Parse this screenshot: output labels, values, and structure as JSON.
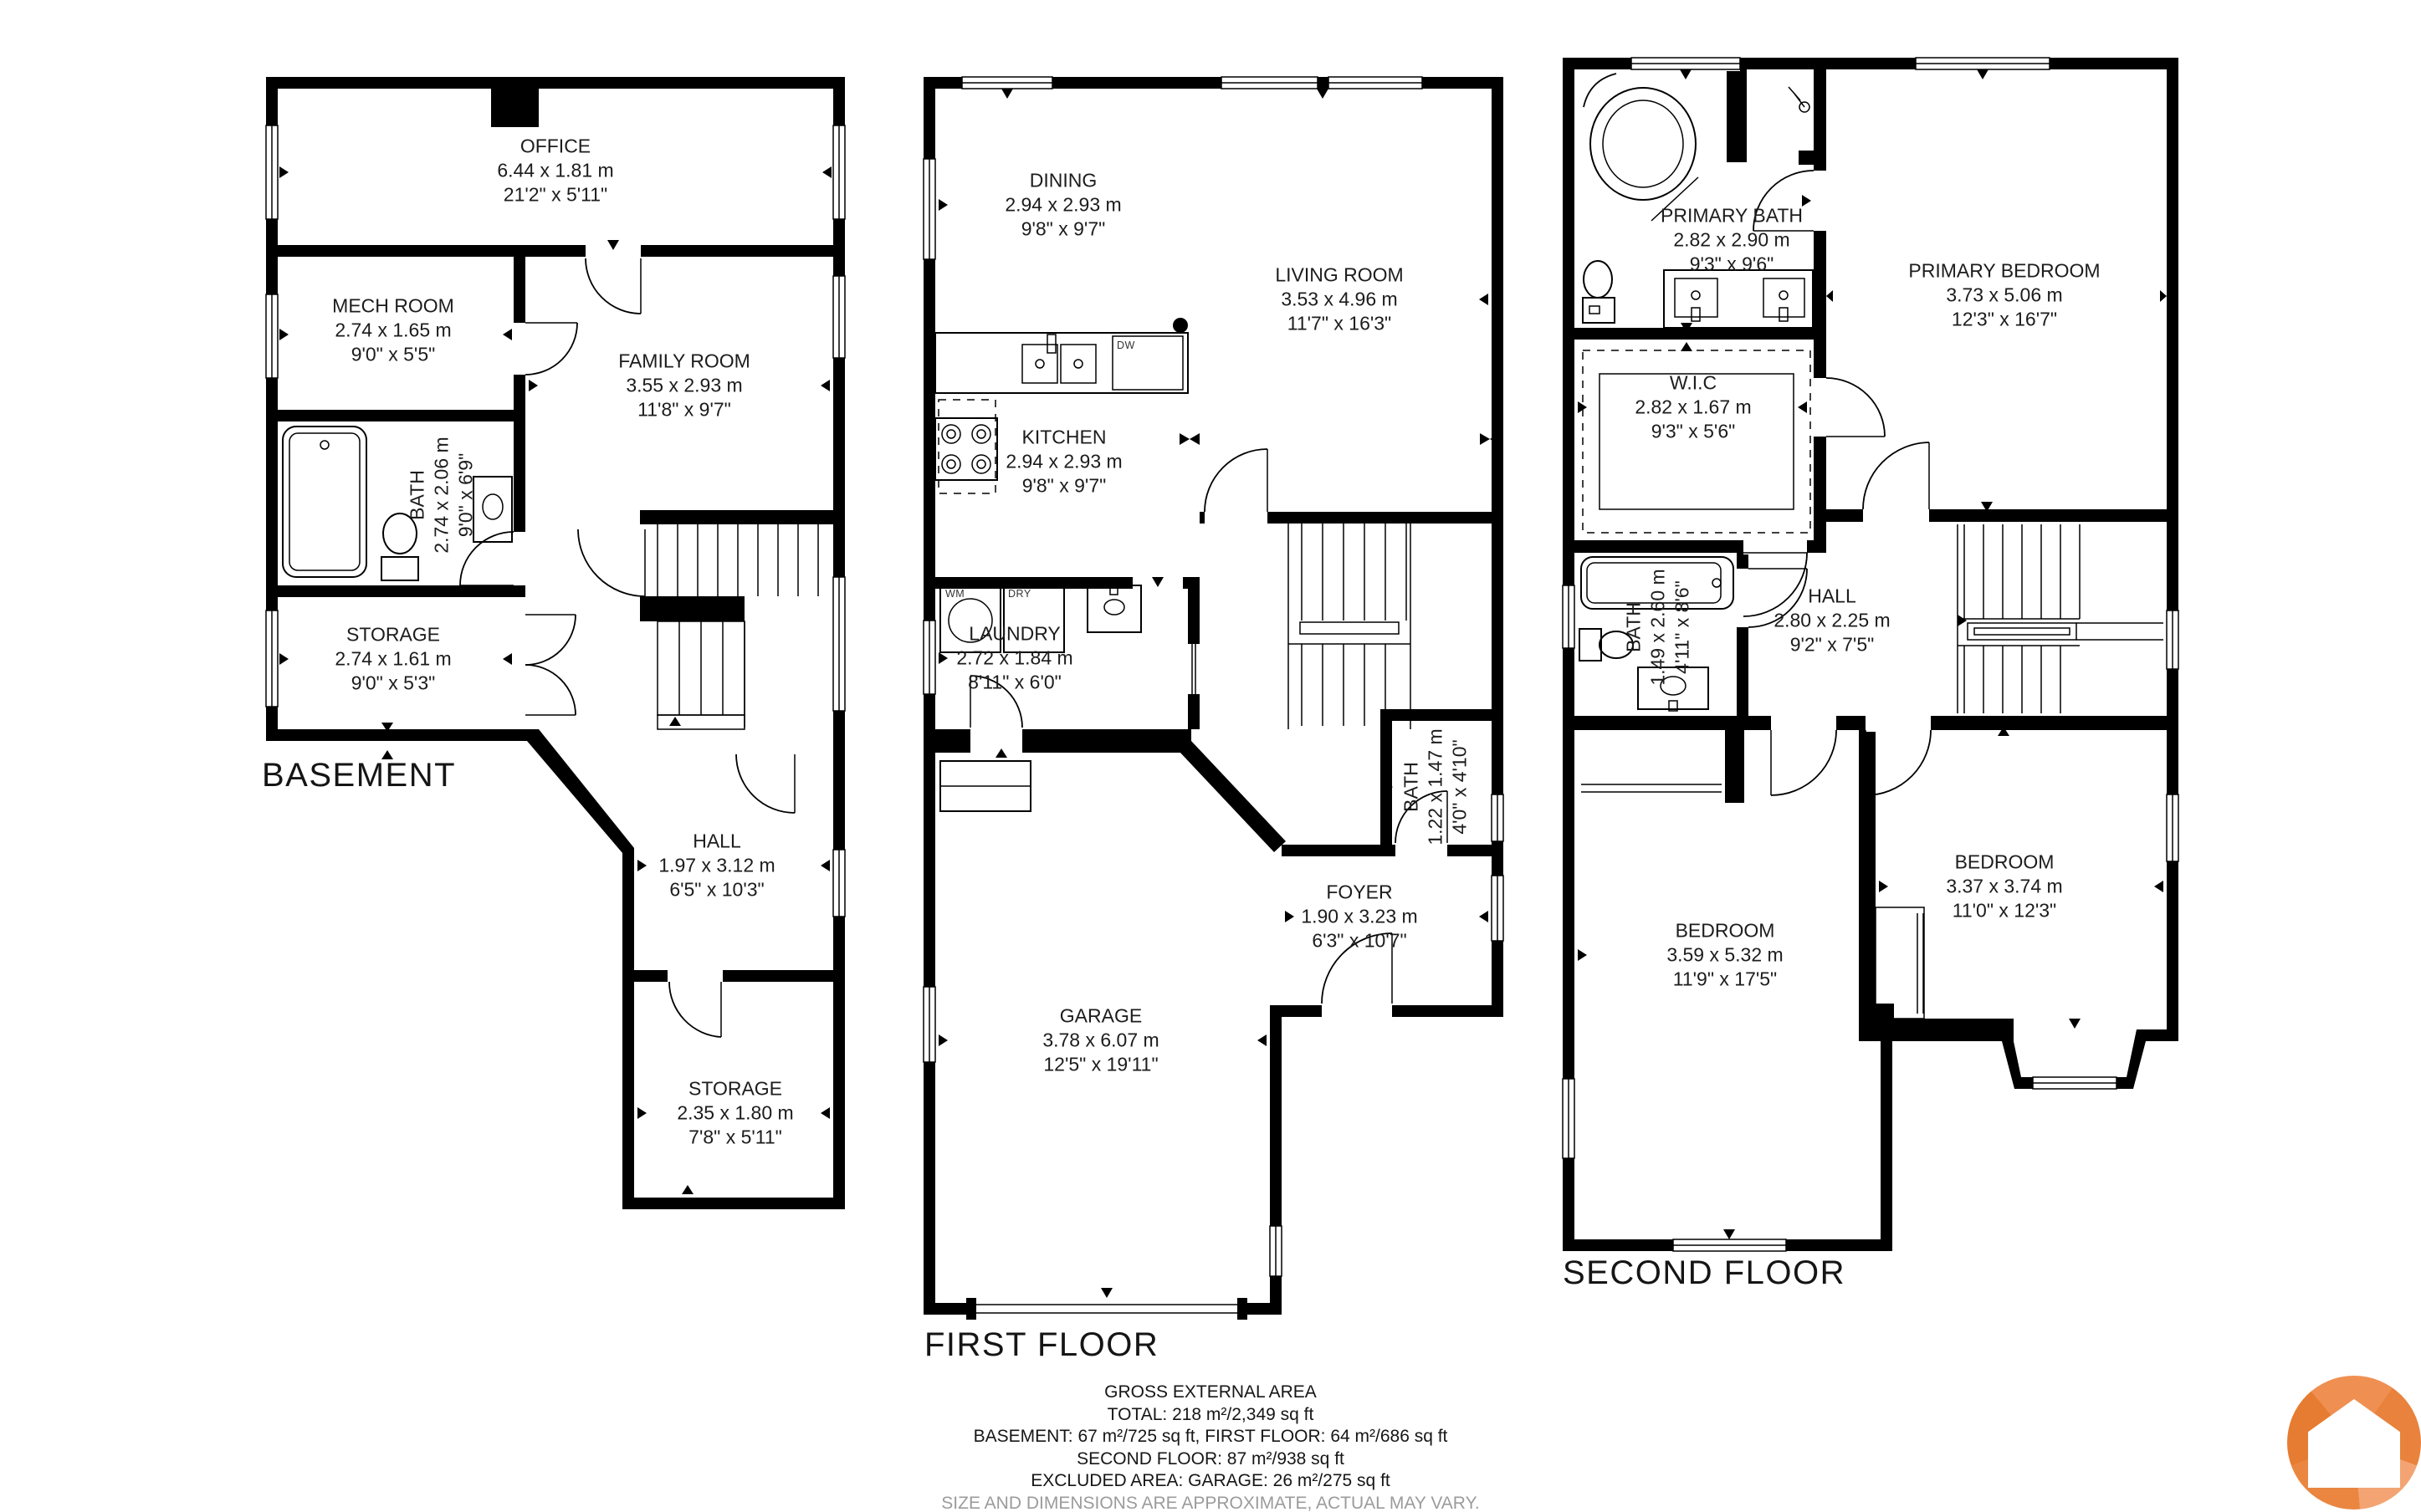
{
  "floors": [
    {
      "title": "BASEMENT",
      "rooms": [
        {
          "name": "OFFICE",
          "metric": "6.44 x 1.81 m",
          "imperial": "21'2\" x 5'11\""
        },
        {
          "name": "MECH ROOM",
          "metric": "2.74 x 1.65 m",
          "imperial": "9'0\" x 5'5\""
        },
        {
          "name": "FAMILY ROOM",
          "metric": "3.55 x 2.93 m",
          "imperial": "11'8\" x 9'7\""
        },
        {
          "name": "BATH",
          "metric": "2.74 x 2.06 m",
          "imperial": "9'0\" x 6'9\""
        },
        {
          "name": "STORAGE",
          "metric": "2.74 x 1.61 m",
          "imperial": "9'0\" x 5'3\""
        },
        {
          "name": "HALL",
          "metric": "1.97 x 3.12 m",
          "imperial": "6'5\" x 10'3\""
        },
        {
          "name": "STORAGE",
          "metric": "2.35 x 1.80 m",
          "imperial": "7'8\" x 5'11\""
        }
      ]
    },
    {
      "title": "FIRST FLOOR",
      "rooms": [
        {
          "name": "DINING",
          "metric": "2.94 x 2.93 m",
          "imperial": "9'8\" x 9'7\""
        },
        {
          "name": "LIVING ROOM",
          "metric": "3.53 x 4.96 m",
          "imperial": "11'7\" x 16'3\""
        },
        {
          "name": "KITCHEN",
          "metric": "2.94 x 2.93 m",
          "imperial": "9'8\" x 9'7\""
        },
        {
          "name": "LAUNDRY",
          "metric": "2.72 x 1.84 m",
          "imperial": "8'11\" x 6'0\""
        },
        {
          "name": "BATH",
          "metric": "1.22 x 1.47 m",
          "imperial": "4'0\" x 4'10\""
        },
        {
          "name": "FOYER",
          "metric": "1.90 x 3.23 m",
          "imperial": "6'3\" x 10'7\""
        },
        {
          "name": "GARAGE",
          "metric": "3.78 x 6.07 m",
          "imperial": "12'5\" x 19'11\""
        }
      ]
    },
    {
      "title": "SECOND FLOOR",
      "rooms": [
        {
          "name": "PRIMARY BATH",
          "metric": "2.82 x 2.90 m",
          "imperial": "9'3\" x 9'6\""
        },
        {
          "name": "PRIMARY BEDROOM",
          "metric": "3.73 x 5.06 m",
          "imperial": "12'3\" x 16'7\""
        },
        {
          "name": "W.I.C",
          "metric": "2.82 x 1.67 m",
          "imperial": "9'3\" x 5'6\""
        },
        {
          "name": "BATH",
          "metric": "1.49 x 2.60 m",
          "imperial": "4'11\" x 8'6\""
        },
        {
          "name": "HALL",
          "metric": "2.80 x 2.25 m",
          "imperial": "9'2\" x 7'5\""
        },
        {
          "name": "BEDROOM",
          "metric": "3.59 x 5.32 m",
          "imperial": "11'9\" x 17'5\""
        },
        {
          "name": "BEDROOM",
          "metric": "3.37 x 3.74 m",
          "imperial": "11'0\" x 12'3\""
        }
      ]
    }
  ],
  "appliances": {
    "dw": "DW",
    "wm": "WM",
    "dry": "DRY"
  },
  "summary": {
    "title": "GROSS EXTERNAL AREA",
    "lines": [
      "TOTAL: 218 m²/2,349 sq ft",
      "BASEMENT: 67 m²/725 sq ft, FIRST FLOOR: 64 m²/686 sq ft",
      "SECOND FLOOR: 87 m²/938 sq ft",
      "EXCLUDED AREA: GARAGE: 26 m²/275 sq ft"
    ],
    "disclaimer": "SIZE AND DIMENSIONS ARE APPROXIMATE, ACTUAL MAY VARY."
  },
  "logo": {
    "primary": "#ef9052",
    "dark": "#e8823c",
    "light": "#f3a472",
    "mid": "#ea8640",
    "deep": "#e67c31",
    "house": "#ffffff"
  }
}
